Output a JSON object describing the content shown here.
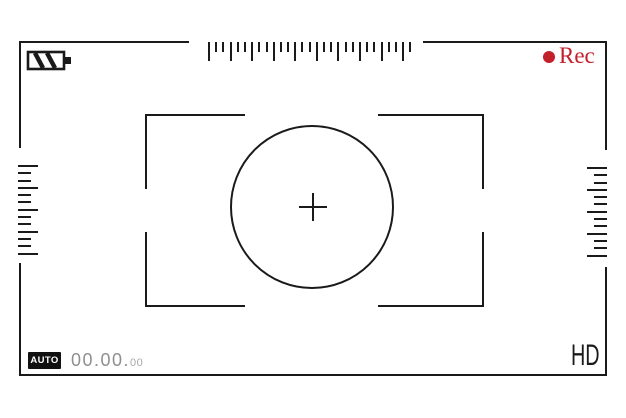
{
  "colors": {
    "stroke": "#1a1a1a",
    "rec_red": "#c2202a",
    "timer_gray": "#8f8f8f",
    "timer_small_gray": "#a8a8a8",
    "badge_bg": "#111111",
    "badge_text": "#ffffff",
    "background": "#ffffff"
  },
  "header": {
    "battery_icon": "battery-level-icon",
    "top_ruler": {
      "tick_count": 29,
      "major_every": 3
    },
    "rec": {
      "dot_icon": "record-dot-icon",
      "label": "Rec"
    }
  },
  "scales": {
    "left": {
      "tick_count": 13,
      "major_every": 3
    },
    "right": {
      "tick_count": 13,
      "major_every": 3
    }
  },
  "focus": {
    "circle_icon": "focus-circle-icon",
    "crosshair_icon": "crosshair-icon"
  },
  "footer": {
    "mode_badge": "AUTO",
    "timer": {
      "main": "00.00.",
      "small": "00"
    },
    "quality": "HD"
  }
}
